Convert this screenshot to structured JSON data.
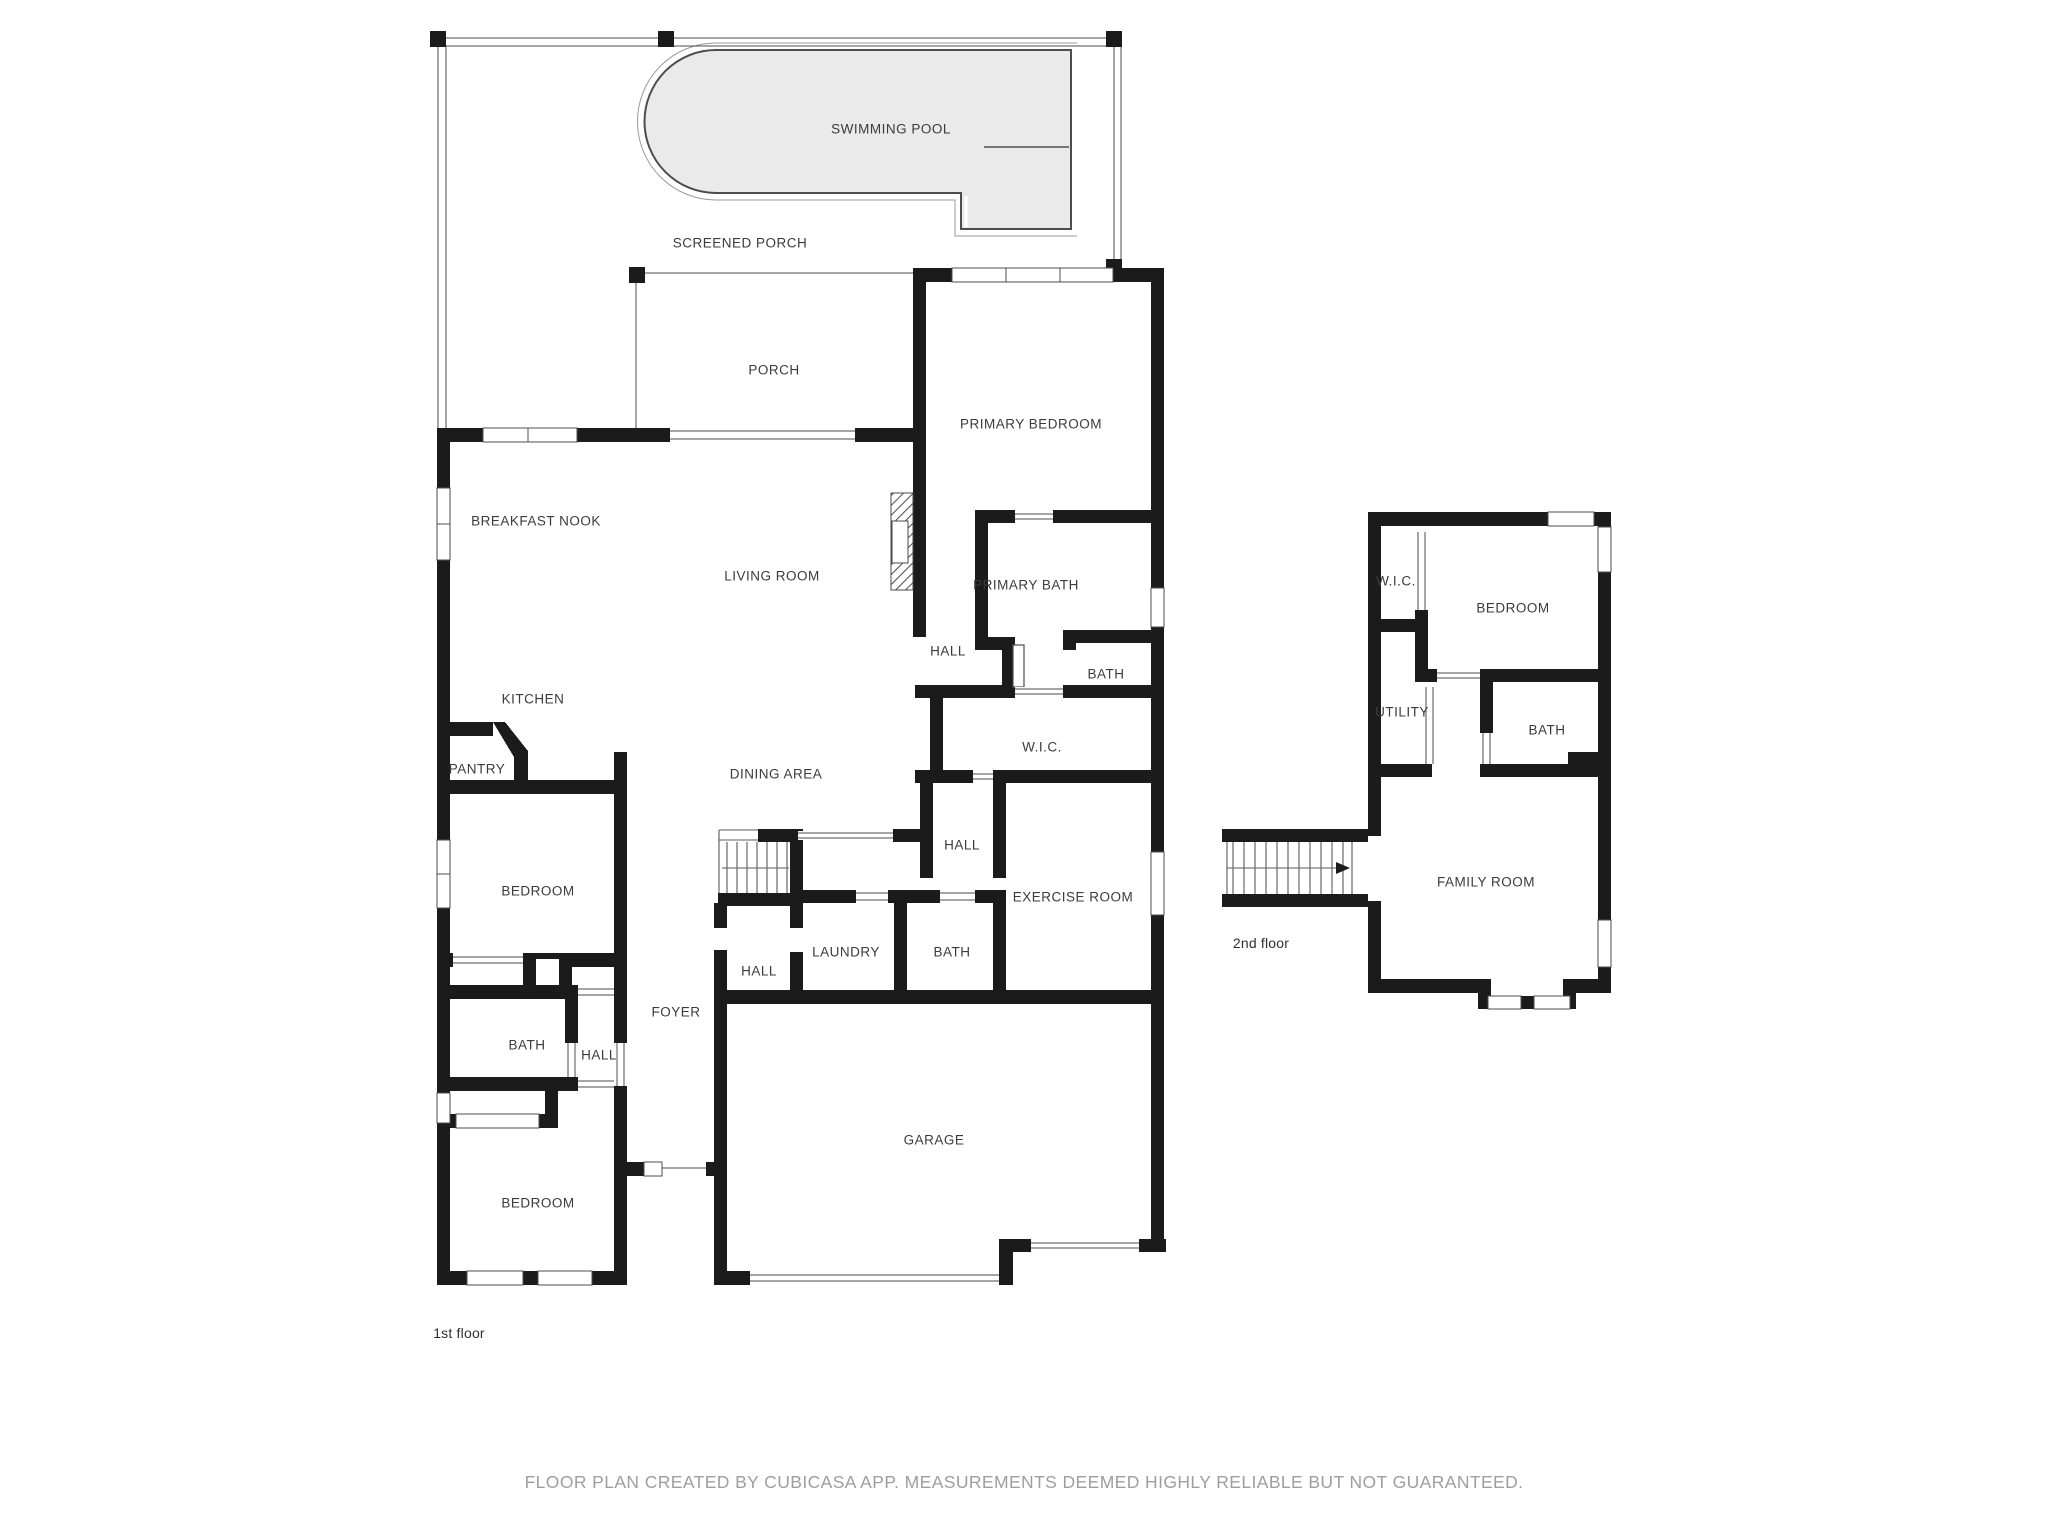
{
  "document": {
    "type": "floor-plan",
    "creator_note": "FLOOR PLAN CREATED BY CUBICASA APP. MEASUREMENTS DEEMED HIGHLY RELIABLE BUT NOT GUARANTEED."
  },
  "colors": {
    "wall": "#1b1b1b",
    "pool_fill": "#eaeaea",
    "line": "#4d4d4d",
    "label": "#3b3b3b",
    "footer_text": "#9e9e9e"
  },
  "floors": [
    {
      "id": "floor-1",
      "name": "1st floor",
      "name_x": 459,
      "name_y": 1333,
      "rooms": [
        {
          "id": "swimming-pool",
          "label": "SWIMMING POOL",
          "x": 891,
          "y": 129
        },
        {
          "id": "screened-porch",
          "label": "SCREENED PORCH",
          "x": 740,
          "y": 243
        },
        {
          "id": "porch",
          "label": "PORCH",
          "x": 774,
          "y": 370
        },
        {
          "id": "primary-bedroom",
          "label": "PRIMARY BEDROOM",
          "x": 1031,
          "y": 424
        },
        {
          "id": "breakfast-nook",
          "label": "BREAKFAST NOOK",
          "x": 536,
          "y": 521
        },
        {
          "id": "living-room",
          "label": "LIVING ROOM",
          "x": 772,
          "y": 576
        },
        {
          "id": "primary-bath",
          "label": "PRIMARY BATH",
          "x": 1026,
          "y": 585
        },
        {
          "id": "hall-upper",
          "label": "HALL",
          "x": 948,
          "y": 651
        },
        {
          "id": "bath-upper",
          "label": "BATH",
          "x": 1106,
          "y": 674
        },
        {
          "id": "kitchen",
          "label": "KITCHEN",
          "x": 533,
          "y": 699
        },
        {
          "id": "wic",
          "label": "W.I.C.",
          "x": 1042,
          "y": 747
        },
        {
          "id": "pantry",
          "label": "PANTRY",
          "x": 477,
          "y": 769
        },
        {
          "id": "dining-area",
          "label": "DINING AREA",
          "x": 776,
          "y": 774
        },
        {
          "id": "hall-middle",
          "label": "HALL",
          "x": 962,
          "y": 845
        },
        {
          "id": "bedroom-upper",
          "label": "BEDROOM",
          "x": 538,
          "y": 891
        },
        {
          "id": "exercise-room",
          "label": "EXERCISE ROOM",
          "x": 1073,
          "y": 897
        },
        {
          "id": "laundry",
          "label": "LAUNDRY",
          "x": 846,
          "y": 952
        },
        {
          "id": "bath-middle",
          "label": "BATH",
          "x": 952,
          "y": 952
        },
        {
          "id": "hall-stairs",
          "label": "HALL",
          "x": 759,
          "y": 971
        },
        {
          "id": "foyer",
          "label": "FOYER",
          "x": 676,
          "y": 1012
        },
        {
          "id": "bath-lower",
          "label": "BATH",
          "x": 527,
          "y": 1045
        },
        {
          "id": "hall-lower",
          "label": "HALL",
          "x": 599,
          "y": 1055
        },
        {
          "id": "garage",
          "label": "GARAGE",
          "x": 934,
          "y": 1140
        },
        {
          "id": "bedroom-lower",
          "label": "BEDROOM",
          "x": 538,
          "y": 1203
        }
      ]
    },
    {
      "id": "floor-2",
      "name": "2nd floor",
      "name_x": 1261,
      "name_y": 943,
      "rooms": [
        {
          "id": "wic-2",
          "label": "W.I.C.",
          "x": 1396,
          "y": 581
        },
        {
          "id": "bedroom-2",
          "label": "BEDROOM",
          "x": 1513,
          "y": 608
        },
        {
          "id": "utility",
          "label": "UTILITY",
          "x": 1402,
          "y": 712
        },
        {
          "id": "bath-2",
          "label": "BATH",
          "x": 1547,
          "y": 730
        },
        {
          "id": "family-room",
          "label": "FAMILY ROOM",
          "x": 1486,
          "y": 882
        }
      ]
    }
  ]
}
